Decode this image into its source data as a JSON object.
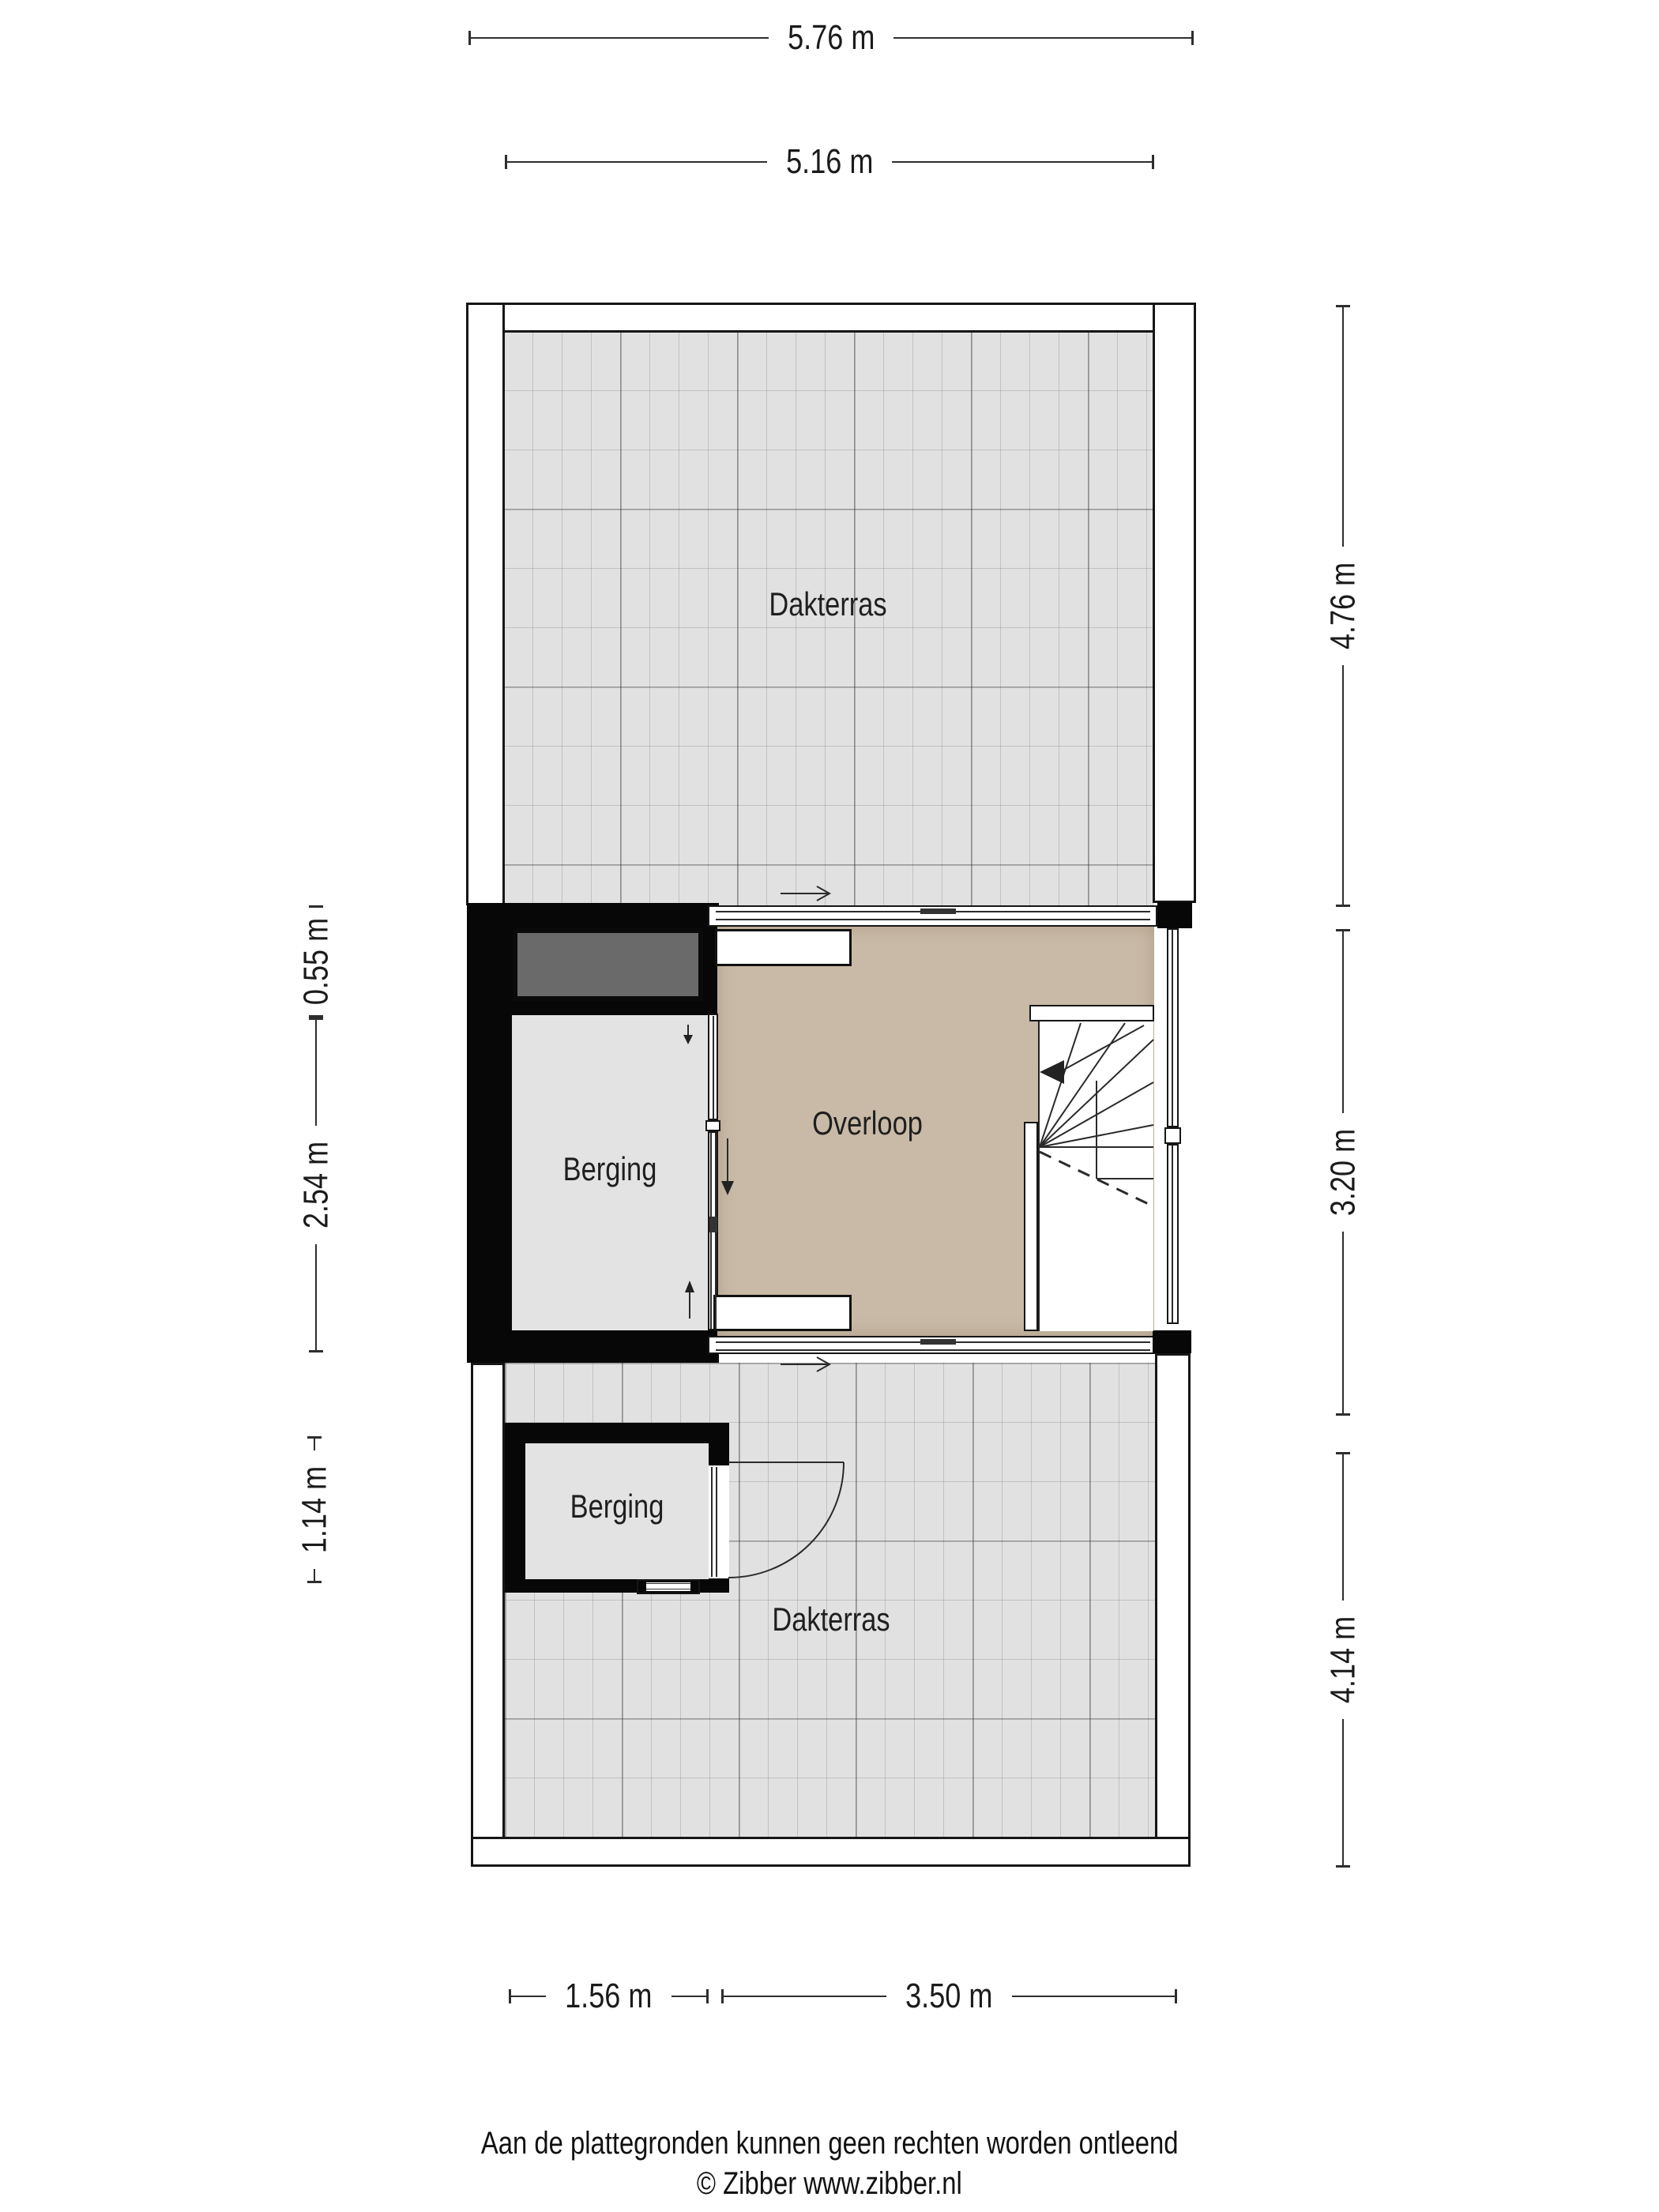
{
  "rooms": {
    "dakterras_top": "Dakterras",
    "berging_mid": "Berging",
    "overloop": "Overloop",
    "berging_bottom": "Berging",
    "dakterras_bottom": "Dakterras"
  },
  "dimensions": {
    "top_outer": "5.76 m",
    "top_inner": "5.16 m",
    "left_upper": "0.55 m",
    "left_middle": "2.54 m",
    "left_lower": "1.14 m",
    "right_upper": "4.76 m",
    "right_middle": "3.20 m",
    "right_lower": "4.14 m",
    "bottom_left": "1.56 m",
    "bottom_right": "3.50 m"
  },
  "footer": {
    "disclaimer": "Aan de plattegronden kunnen geen rechten worden ontleend",
    "credit": "© Zibber www.zibber.nl"
  },
  "colors": {
    "overloop_floor": "#c9baa7",
    "terrace_tile": "#e1e1e1",
    "storage_floor": "#e3e3e3",
    "dark_fixture": "#6a6a6a",
    "wall": "#070707"
  }
}
